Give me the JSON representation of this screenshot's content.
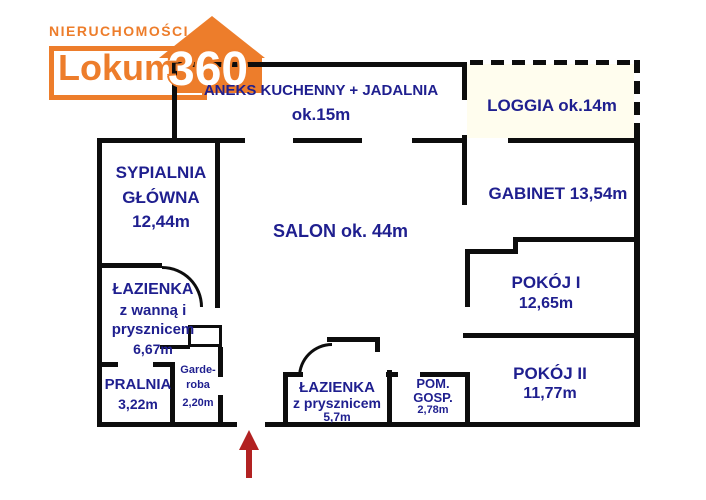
{
  "logo": {
    "tagline": "NIERUCHOMOŚCI",
    "name": "Lokum",
    "badge": "360"
  },
  "colors": {
    "accent_orange": "#ed7d2b",
    "label_navy": "#1f1f8f",
    "wall_black": "#0d0d0d",
    "arrow_red": "#b22222",
    "loggia_bg": "#fffdee"
  },
  "icons": {
    "entrance_arrow": "arrow-up"
  },
  "rooms": {
    "kitchen": [
      "ANEKS KUCHENNY + JADALNIA",
      "ok.15m"
    ],
    "loggia": [
      "LOGGIA ok.14m"
    ],
    "master_bedroom": [
      "SYPIALNIA",
      "GŁÓWNA",
      "12,44m"
    ],
    "salon": [
      "SALON ok. 44m"
    ],
    "office": [
      "GABINET 13,54m"
    ],
    "room1": [
      "POKÓJ I",
      "12,65m"
    ],
    "bathroom_tub": [
      "ŁAZIENKA",
      "z wanną i",
      "prysznicem",
      "6,67m"
    ],
    "laundry": [
      "PRALNIA",
      "3,22m"
    ],
    "wardrobe": [
      "Garde-",
      "roba",
      "2,20m"
    ],
    "bathroom_shower": [
      "ŁAZIENKA",
      "z prysznicem",
      "5,7m"
    ],
    "utility": [
      "POM.",
      "GOSP.",
      "2,78m"
    ],
    "room2": [
      "POKÓJ II",
      "11,77m"
    ]
  },
  "floorplan": {
    "walls": [
      [
        172,
        62,
        295,
        5
      ],
      [
        172,
        62,
        5,
        80
      ],
      [
        97,
        138,
        148,
        5
      ],
      [
        293,
        138,
        69,
        5
      ],
      [
        412,
        138,
        55,
        5
      ],
      [
        97,
        138,
        5,
        289
      ],
      [
        97,
        422,
        140,
        5
      ],
      [
        265,
        422,
        375,
        5
      ],
      [
        634,
        132,
        6,
        295
      ],
      [
        462,
        62,
        5,
        38
      ],
      [
        462,
        135,
        5,
        70
      ],
      [
        508,
        138,
        132,
        5
      ],
      [
        513,
        237,
        127,
        5
      ],
      [
        513,
        237,
        5,
        17
      ],
      [
        465,
        249,
        53,
        5
      ],
      [
        465,
        249,
        5,
        58
      ],
      [
        463,
        333,
        177,
        5
      ],
      [
        465,
        374,
        5,
        53
      ],
      [
        386,
        372,
        12,
        5
      ],
      [
        420,
        372,
        50,
        5
      ],
      [
        387,
        370,
        5,
        57
      ],
      [
        327,
        337,
        53,
        5
      ],
      [
        375,
        337,
        5,
        15
      ],
      [
        283,
        372,
        5,
        55
      ],
      [
        283,
        372,
        20,
        5
      ],
      [
        215,
        140,
        5,
        168
      ],
      [
        97,
        263,
        65,
        5
      ],
      [
        97,
        362,
        21,
        5
      ],
      [
        153,
        362,
        20,
        5
      ],
      [
        170,
        362,
        5,
        65
      ],
      [
        218,
        347,
        5,
        30
      ],
      [
        218,
        395,
        5,
        32
      ],
      [
        188,
        325,
        34,
        3
      ],
      [
        188,
        325,
        3,
        22
      ],
      [
        219,
        325,
        3,
        22
      ],
      [
        188,
        344,
        32,
        3
      ],
      [
        160,
        345,
        30,
        4
      ]
    ],
    "dashed_walls": [
      {
        "x": 470,
        "y": 60,
        "len": 168,
        "dir": "h"
      },
      {
        "x": 634,
        "y": 60,
        "len": 78,
        "dir": "v"
      }
    ],
    "door_arcs": [
      {
        "x": 162,
        "y": 266,
        "r": 38,
        "corner": "tr"
      },
      {
        "x": 298,
        "y": 343,
        "r": 31,
        "corner": "tl"
      }
    ],
    "entrance_arrow": {
      "x": 249,
      "y": 431
    }
  }
}
